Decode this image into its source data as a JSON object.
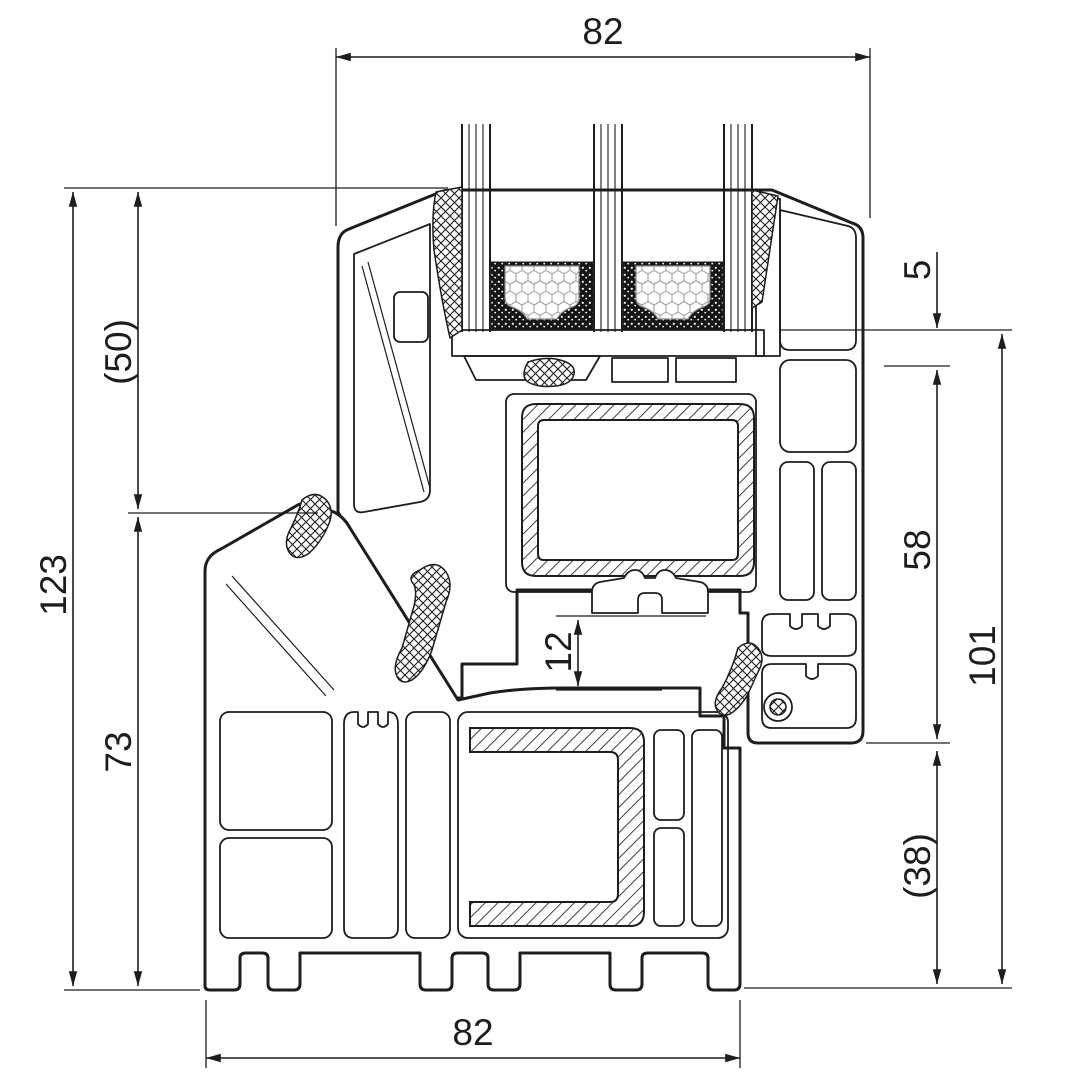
{
  "drawing": {
    "background_color": "#ffffff",
    "line_color": "#1d1d1d",
    "content": "window-profile-cross-section"
  },
  "dimensions": {
    "top_width": "82",
    "bottom_width": "82",
    "left_total_height": "123",
    "left_upper_height": "(50)",
    "left_lower_height": "73",
    "right_edge_offset": "5",
    "right_upper_height": "58",
    "right_overall_height": "101",
    "right_lower_height": "(38)",
    "rebate_gap": "12"
  }
}
